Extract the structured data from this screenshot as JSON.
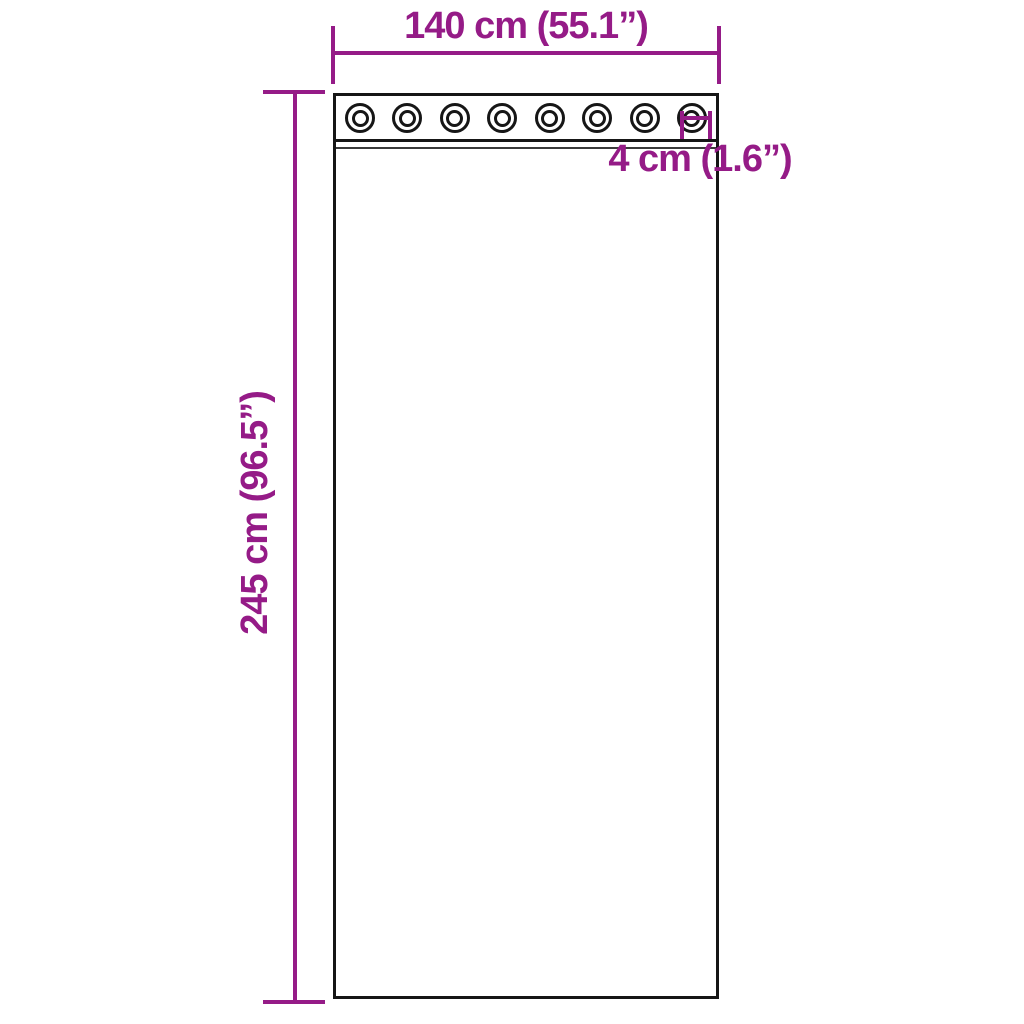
{
  "colors": {
    "accent": "#951B87",
    "line": "#161616",
    "background": "#FFFFFF"
  },
  "curtain": {
    "grommet_count": 8
  },
  "dimensions": {
    "width": {
      "label": "140 cm (55.1”)"
    },
    "height": {
      "label": "245 cm (96.5”)"
    },
    "grommet_diameter": {
      "label": "4 cm (1.6”)"
    }
  }
}
